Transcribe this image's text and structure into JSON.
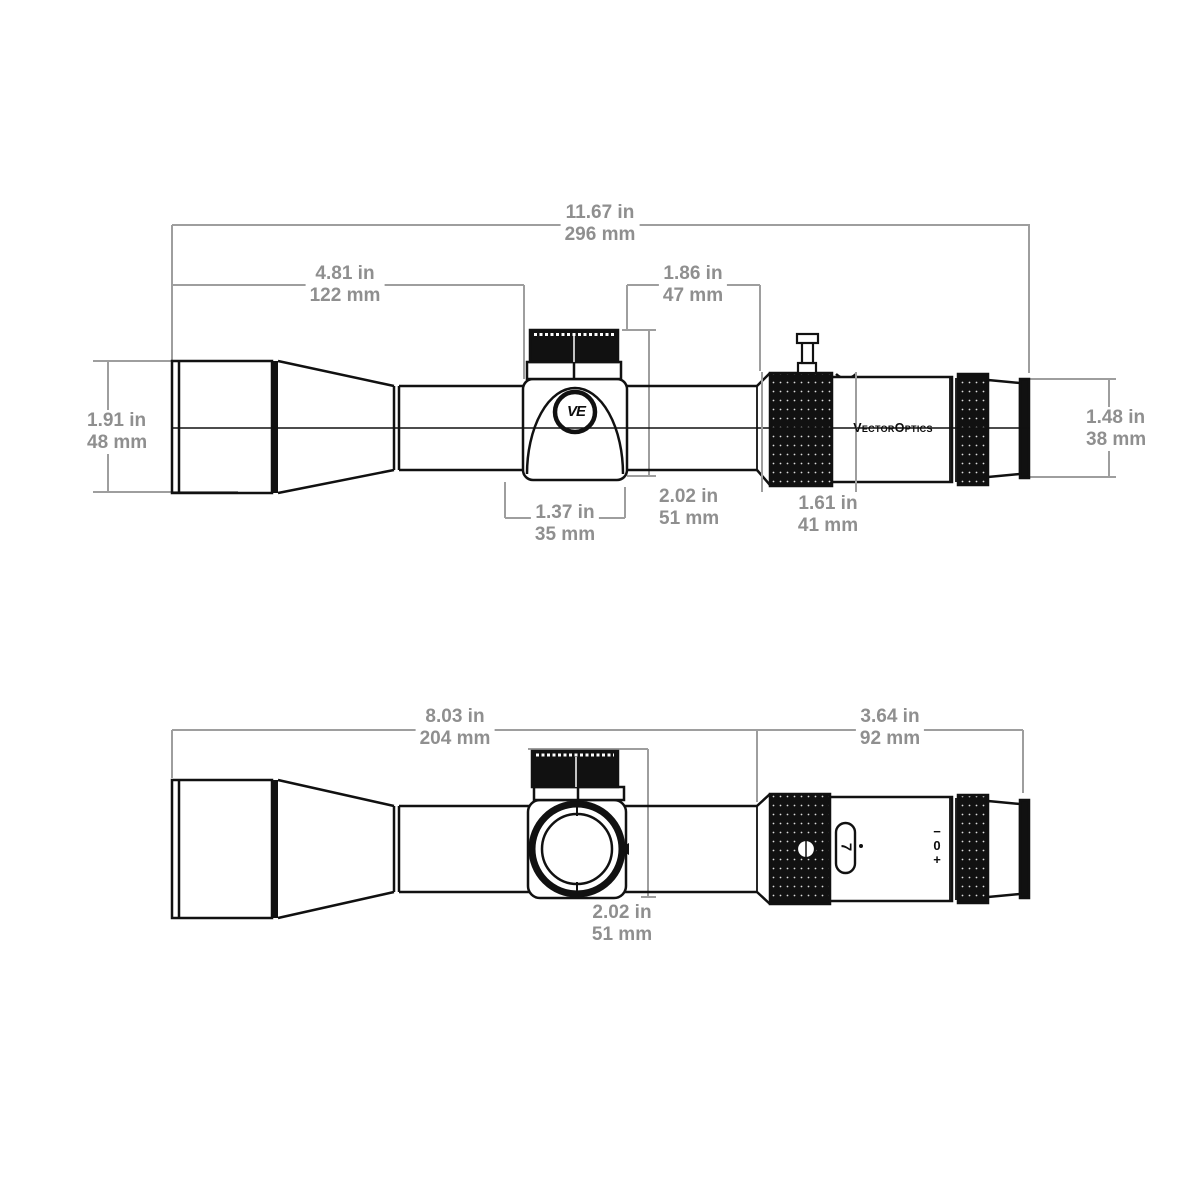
{
  "drawing": {
    "subject": "riflescope dimensional drawing",
    "colors": {
      "ink": "#111111",
      "dim_line": "#9e9e9e",
      "dim_text": "#8f8f8f",
      "background": "#ffffff"
    }
  },
  "dimensions": {
    "overall_length": {
      "in": "11.67 in",
      "mm": "296 mm"
    },
    "objective_section": {
      "in": "4.81 in",
      "mm": "122 mm"
    },
    "turret_section": {
      "in": "1.86 in",
      "mm": "47 mm"
    },
    "objective_diameter": {
      "in": "1.91 in",
      "mm": "48 mm"
    },
    "eyepiece_diameter": {
      "in": "1.48 in",
      "mm": "38 mm"
    },
    "saddle_width": {
      "in": "1.37 in",
      "mm": "35 mm"
    },
    "turret_height_side": {
      "in": "2.02 in",
      "mm": "51 mm"
    },
    "power_ring_section": {
      "in": "1.61 in",
      "mm": "41 mm"
    },
    "mount_tube_length": {
      "in": "8.03 in",
      "mm": "204 mm"
    },
    "eyepiece_assembly": {
      "in": "3.64 in",
      "mm": "92 mm"
    },
    "turret_height_top": {
      "in": "2.02 in",
      "mm": "51 mm"
    }
  },
  "labels": {
    "brand": "VectorOptics",
    "logo_monogram": "VE",
    "magnification": "7",
    "diopter": {
      "minus": "−",
      "zero": "0",
      "plus": "+"
    }
  }
}
